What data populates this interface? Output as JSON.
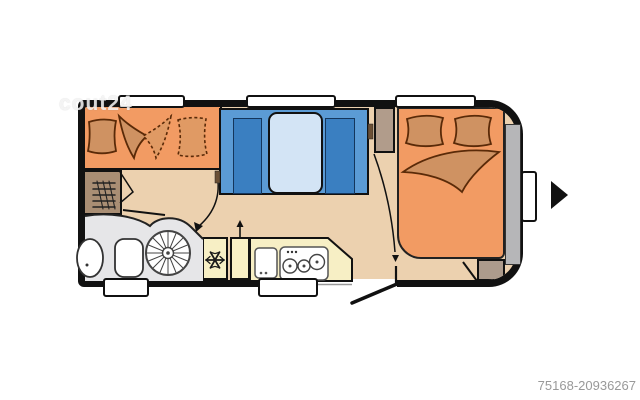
{
  "watermark": {
    "text": "cout24"
  },
  "footer": {
    "listing_id": "75168-20936267"
  },
  "floorplan": {
    "type": "caravan-floor-plan",
    "orientation": "hitch-right",
    "palette": {
      "wall_black": "#111111",
      "upholstery_orange": "#f29b63",
      "pillow_orange": "#cf9262",
      "floor_tan": "#ecd1af",
      "bench_blue": "#5b9bd5",
      "cushion_blue": "#3a7fc1",
      "table_blue": "#d3e4f5",
      "kitchen_yellow": "#f7efc5",
      "bathroom_gray": "#e6e6e8",
      "cabinet_brown": "#a98e74",
      "wardrobe_tan": "#b19c8b",
      "storage_gray": "#b6b6b8",
      "id_text_gray": "#999999"
    },
    "areas": [
      "front-bunk-bed",
      "heater-cabinet",
      "washroom",
      "shower",
      "toilet",
      "washbasin",
      "fridge-with-snowflake",
      "kitchen-cabinet",
      "kitchen-counter",
      "kitchen-sink",
      "three-burner-hob",
      "dinette-bench-left",
      "dinette-bench-right",
      "dinette-table",
      "wardrobe",
      "rear-double-bed",
      "bed-foot-cabinet",
      "rear-storage-strip",
      "window-front",
      "window-middle",
      "window-rear",
      "side-window",
      "service-door-bath",
      "service-door-kitchen",
      "entry-door"
    ],
    "markers": {
      "entry_arrow": "down",
      "kitchen_arrow": "up",
      "hitch_arrow": "right"
    }
  }
}
